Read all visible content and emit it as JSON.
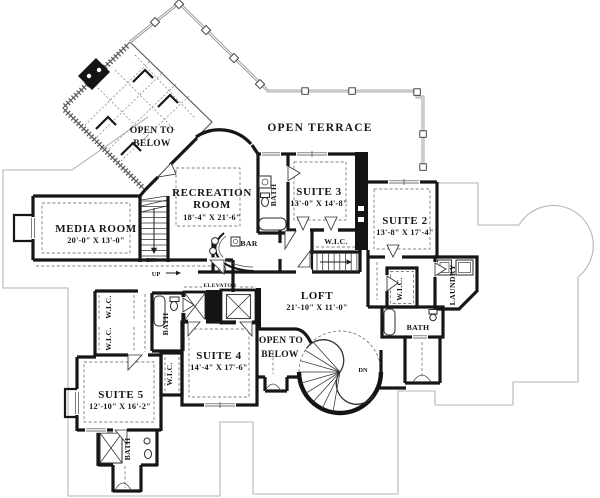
{
  "floorplan": {
    "rooms": {
      "open_to_below_upper": {
        "line1": "OPEN TO",
        "line2": "BELOW"
      },
      "open_terrace": {
        "name": "OPEN TERRACE"
      },
      "recreation_room": {
        "name_line1": "RECREATION",
        "name_line2": "ROOM",
        "dims": "18'-4\" X 21'-6\""
      },
      "suite_3": {
        "name": "SUITE 3",
        "dims": "13'-0\" X 14'-8\""
      },
      "suite_2": {
        "name": "SUITE 2",
        "dims": "13'-8\" X 17'-4\""
      },
      "media_room": {
        "name": "MEDIA ROOM",
        "dims": "20'-0\" X 13'-0\""
      },
      "loft": {
        "name": "LOFT",
        "dims": "21'-10\" X 11'-0\""
      },
      "suite_4": {
        "name": "SUITE 4",
        "dims": "14'-4\" X 17'-6\""
      },
      "suite_5": {
        "name": "SUITE 5",
        "dims": "12'-10\" X 16'-2\""
      },
      "open_to_below_center": {
        "line1": "OPEN TO",
        "line2": "BELOW"
      },
      "bar": {
        "name": "BAR"
      },
      "laundry": {
        "name": "LAUNDRY"
      }
    },
    "closets": {
      "wic_suite3": "W.I.C.",
      "wic_right": "W.I.C.",
      "wic_left_upper": "W.I.C.",
      "wic_left_lower": "W.I.C.",
      "wic_suite4": "W.I.C."
    },
    "baths": {
      "bath_suite3": "BATH",
      "bath_left": "BATH",
      "bath_right": "BATH",
      "bath_suite5": "BATH"
    },
    "stairs": {
      "dn_main": "DN",
      "up_main": "UP",
      "dn_spiral": "DN",
      "elevator": "ELEVATOR"
    },
    "colors": {
      "wall": "#161616",
      "roof_outline": "#b5b5b5",
      "background": "#ffffff"
    }
  }
}
